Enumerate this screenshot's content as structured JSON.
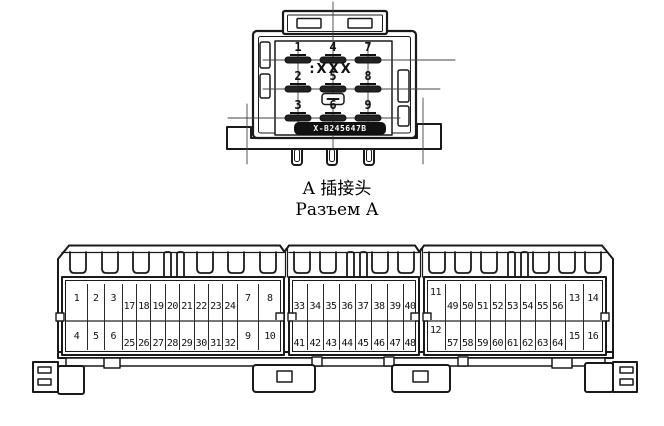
{
  "connector_a": {
    "caption_zh": "A 插接头",
    "caption_ru": "Разъем А",
    "marking": ":XXX",
    "badge_text": "X-B245647B",
    "pin_rows": [
      [
        "1",
        "4",
        "7"
      ],
      [
        "2",
        "5",
        "8"
      ],
      [
        "3",
        "6",
        "9"
      ]
    ]
  },
  "connector_b": {
    "sections": [
      {
        "top": [
          "1",
          "2",
          "3",
          "17",
          "18",
          "19",
          "20",
          "21",
          "22",
          "23",
          "24",
          "7",
          "8"
        ],
        "bottom": [
          "4",
          "5",
          "6",
          "25",
          "26",
          "27",
          "28",
          "29",
          "30",
          "31",
          "32",
          "9",
          "10"
        ]
      },
      {
        "top": [
          "33",
          "34",
          "35",
          "36",
          "37",
          "38",
          "39",
          "40"
        ],
        "bottom": [
          "41",
          "42",
          "43",
          "44",
          "45",
          "46",
          "47",
          "48"
        ]
      },
      {
        "top": [
          "11",
          "49",
          "50",
          "51",
          "52",
          "53",
          "54",
          "55",
          "56",
          "13",
          "14"
        ],
        "bottom": [
          "12",
          "57",
          "58",
          "59",
          "60",
          "61",
          "62",
          "63",
          "64",
          "15",
          "16"
        ]
      }
    ]
  },
  "colors": {
    "line": "#1a1a1a",
    "pin_fill": "#222222",
    "badge_bg": "#111111",
    "badge_fg": "#ffffff",
    "background": "#ffffff"
  }
}
